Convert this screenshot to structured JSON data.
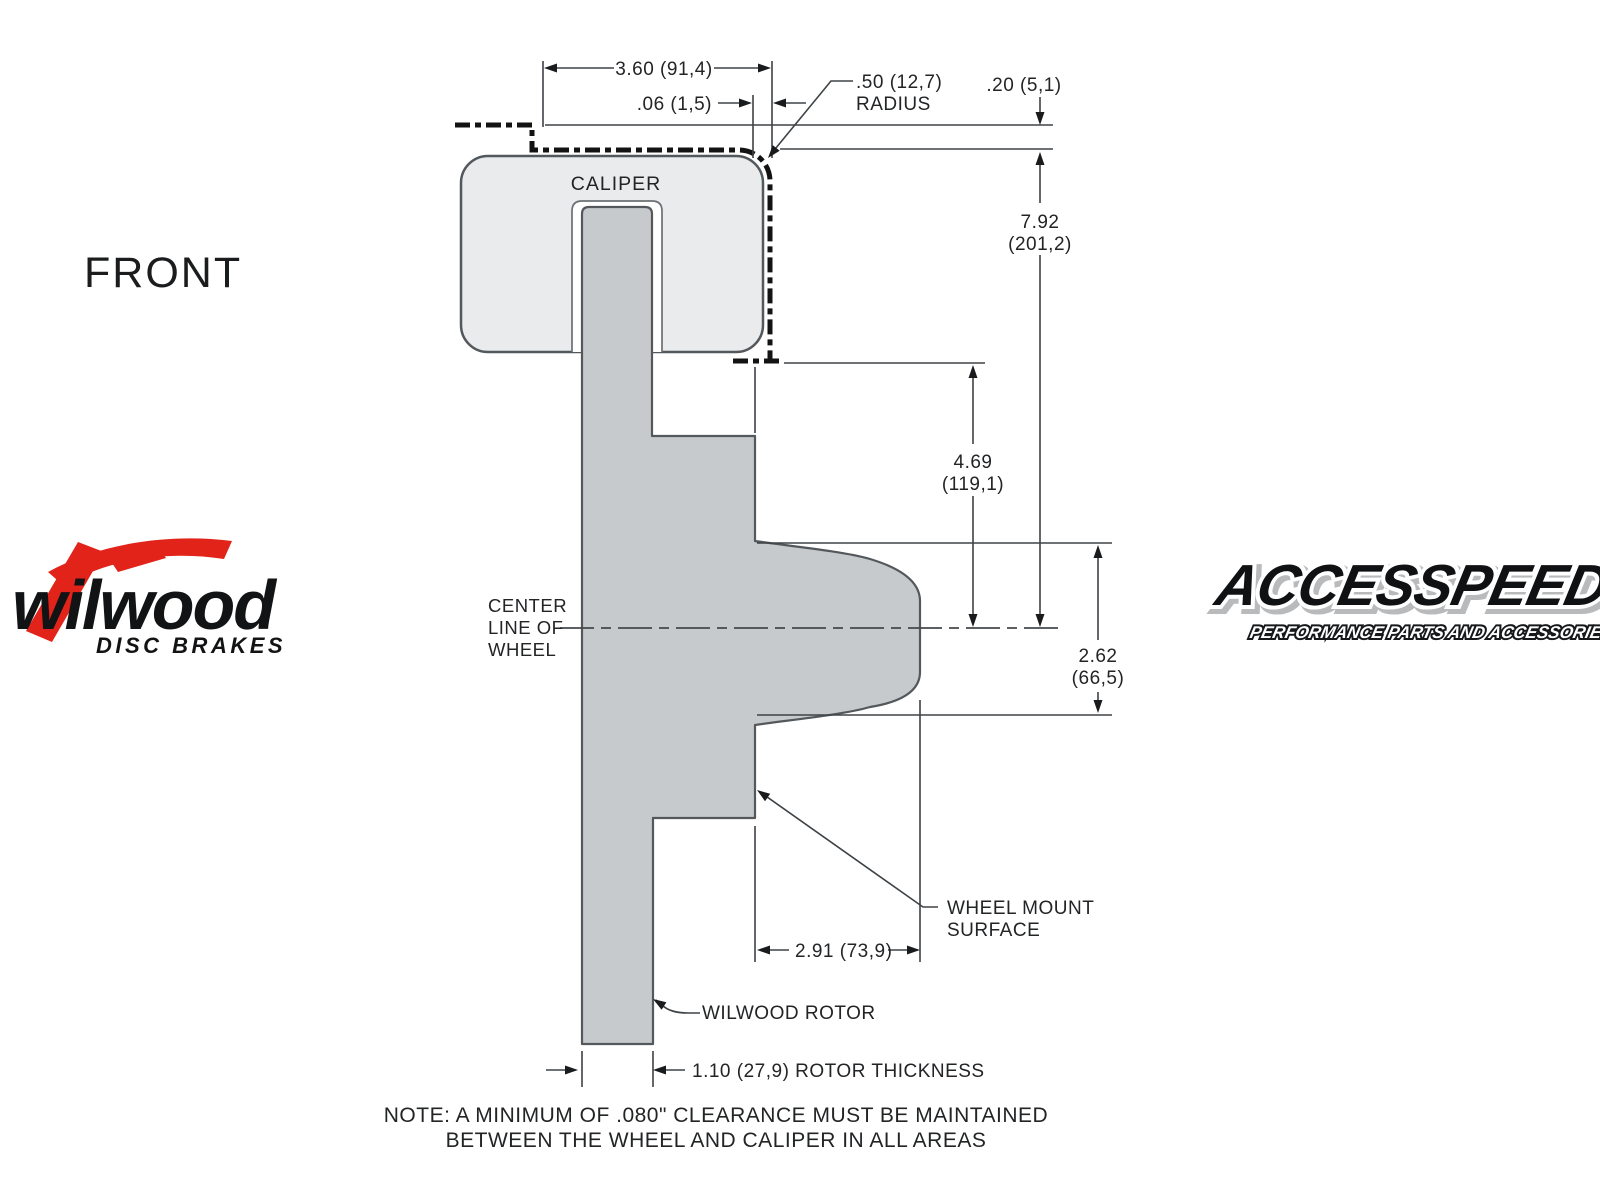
{
  "colors": {
    "background": "#ffffff",
    "caliper_fill": "#e9ebec",
    "rotor_fill": "#c7cacc",
    "outline": "#53585c",
    "dim_line": "#3e4347",
    "text": "#222426",
    "dashed_wheel_line": "#131313",
    "wilwood_red": "#e2231a"
  },
  "labels": {
    "front": "FRONT",
    "caliper": "CALIPER",
    "center_line_1": "CENTER",
    "center_line_2": "LINE OF",
    "center_line_3": "WHEEL",
    "wheel_mount_1": "WHEEL MOUNT",
    "wheel_mount_2": "SURFACE",
    "wilwood_rotor": "WILWOOD ROTOR",
    "note_1": "NOTE: A MINIMUM OF .080\" CLEARANCE MUST BE MAINTAINED",
    "note_2": "BETWEEN THE WHEEL AND CALIPER IN ALL AREAS"
  },
  "dimensions": {
    "caliper_width": "3.60 (91,4)",
    "clearance_top": ".06 (1,5)",
    "radius_value": ".50 (12,7)",
    "radius_label": "RADIUS",
    "wheel_step": ".20 (5,1)",
    "caliper_to_center_in": "7.92",
    "caliper_to_center_mm": "(201,2)",
    "flange_to_center_in": "4.69",
    "flange_to_center_mm": "(119,1)",
    "hat_depth_in": "2.62",
    "hat_depth_mm": "(66,5)",
    "hat_width": "2.91 (73,9)",
    "rotor_thickness": "1.10 (27,9) ROTOR THICKNESS"
  },
  "logos": {
    "wilwood_name": "wilwood",
    "wilwood_tagline": "DISC BRAKES",
    "accesspeed_name": "ACCESSPEED",
    "accesspeed_tagline": "PERFORMANCE PARTS AND ACCESSORIES"
  }
}
